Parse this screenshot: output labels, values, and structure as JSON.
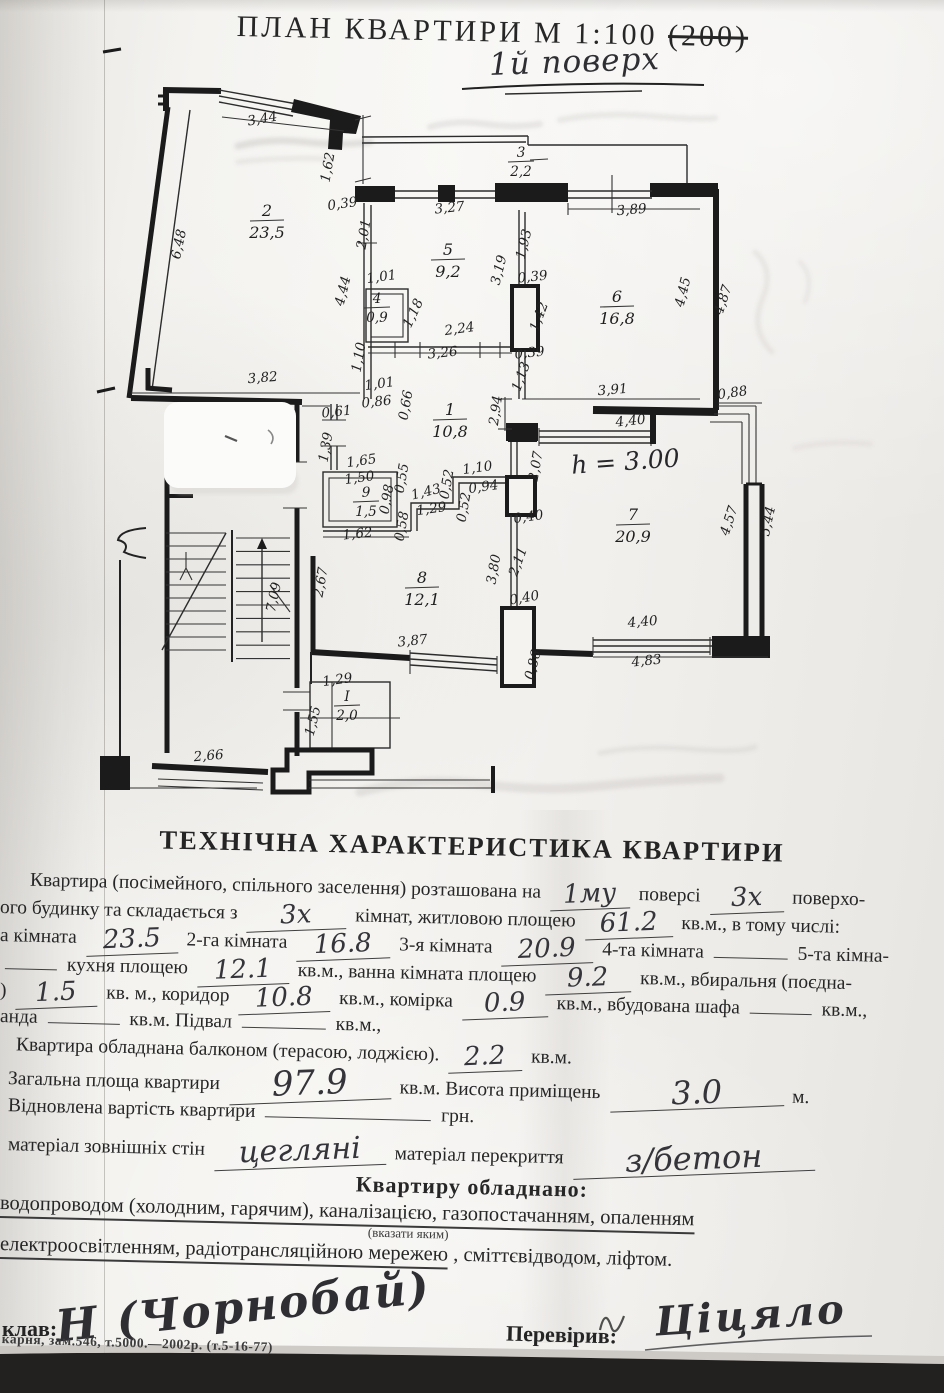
{
  "page": {
    "title": "ПЛАН  КВАРТИРИ  М 1:100",
    "title_struck": "(200)",
    "floor_note": "1й поверх"
  },
  "plan": {
    "height_note": "h = 3.00",
    "rooms": [
      {
        "n": "2",
        "a": "23,5",
        "x": 267,
        "y": 216
      },
      {
        "n": "5",
        "a": "9,2",
        "x": 448,
        "y": 255
      },
      {
        "n": "3",
        "a": "2,2",
        "x": 521,
        "y": 157,
        "small": true
      },
      {
        "n": "4",
        "a": "0,9",
        "x": 377,
        "y": 303,
        "small": true
      },
      {
        "n": "6",
        "a": "16,8",
        "x": 617,
        "y": 302
      },
      {
        "n": "1",
        "a": "10,8",
        "x": 450,
        "y": 415
      },
      {
        "n": "9",
        "a": "1,5",
        "x": 366,
        "y": 497,
        "small": true
      },
      {
        "n": "7",
        "a": "20,9",
        "x": 633,
        "y": 520
      },
      {
        "n": "8",
        "a": "12,1",
        "x": 422,
        "y": 583
      },
      {
        "n": "I",
        "a": "2,0",
        "x": 347,
        "y": 701,
        "small": true
      }
    ],
    "dims": [
      [
        "3,44",
        263,
        123,
        -10
      ],
      [
        "6,48",
        183,
        245,
        -78
      ],
      [
        "1,62",
        332,
        168,
        -80
      ],
      [
        "0,39",
        343,
        208,
        -8
      ],
      [
        "3,27",
        450,
        212,
        -6
      ],
      [
        "2,01",
        368,
        235,
        -80
      ],
      [
        "4,44",
        347,
        292,
        -76
      ],
      [
        "1,01",
        382,
        281,
        -8
      ],
      [
        "1,18",
        417,
        315,
        -65
      ],
      [
        "2,24",
        460,
        333,
        -8
      ],
      [
        "3,26",
        443,
        357,
        -6
      ],
      [
        "1,10",
        363,
        358,
        -80
      ],
      [
        "3,82",
        263,
        382,
        -5
      ],
      [
        "1,01",
        380,
        388,
        -8
      ],
      [
        "0,86",
        377,
        406,
        -6
      ],
      [
        "0,66",
        410,
        406,
        -80
      ],
      [
        "0,61",
        337,
        416,
        -6
      ],
      [
        "1,39",
        330,
        448,
        -80
      ],
      [
        "1,93",
        528,
        245,
        -76
      ],
      [
        "3,19",
        503,
        271,
        -76
      ],
      [
        "0,39",
        533,
        281,
        -6
      ],
      [
        "1,42",
        543,
        318,
        -70
      ],
      [
        "0,39",
        530,
        357,
        -6
      ],
      [
        "3,89",
        632,
        214,
        -5
      ],
      [
        "4,45",
        687,
        293,
        -76
      ],
      [
        "4,87",
        727,
        301,
        -72
      ],
      [
        "2,94",
        500,
        411,
        -82
      ],
      [
        "1,13",
        525,
        378,
        -70
      ],
      [
        "3,91",
        613,
        394,
        -5
      ],
      [
        "4,40",
        631,
        425,
        -6
      ],
      [
        "0,88",
        733,
        397,
        -8
      ],
      [
        "2,07",
        540,
        467,
        -80
      ],
      [
        "1,65",
        362,
        465,
        -8
      ],
      [
        "1,50",
        360,
        482,
        -8
      ],
      [
        "0,98",
        391,
        500,
        -80
      ],
      [
        "0,55",
        406,
        479,
        -80
      ],
      [
        "1,43",
        427,
        496,
        -14
      ],
      [
        "1,29",
        432,
        513,
        -8
      ],
      [
        "0,52",
        451,
        485,
        -80
      ],
      [
        "0,52",
        468,
        508,
        -80
      ],
      [
        "1,10",
        478,
        472,
        -8
      ],
      [
        "0,94",
        484,
        491,
        -8
      ],
      [
        "0,58",
        406,
        527,
        -80
      ],
      [
        "1,62",
        358,
        538,
        -6
      ],
      [
        "0,40",
        529,
        521,
        -8
      ],
      [
        "3,80",
        498,
        570,
        -80
      ],
      [
        "2,11",
        522,
        563,
        -70
      ],
      [
        "0,40",
        525,
        602,
        -10
      ],
      [
        "2,67",
        325,
        583,
        -80
      ],
      [
        "7,09",
        278,
        598,
        -78
      ],
      [
        "3,87",
        413,
        645,
        -6
      ],
      [
        "0,86",
        537,
        666,
        -75
      ],
      [
        "4,40",
        643,
        626,
        -5
      ],
      [
        "4,83",
        647,
        665,
        -6
      ],
      [
        "4,57",
        733,
        522,
        -72
      ],
      [
        "5,44",
        772,
        522,
        -78
      ],
      [
        "2,66",
        209,
        760,
        -5
      ],
      [
        "1,29",
        338,
        684,
        -8
      ],
      [
        "1,55",
        317,
        722,
        -76
      ]
    ]
  },
  "tech": {
    "heading": "ТЕХНІЧНА ХАРАКТЕРИСТИКА КВАРТИРИ",
    "lines": [
      {
        "top": 868,
        "indent": 30,
        "segs": [
          {
            "t": "Квартира (посімейного, спільного заселення) розташована на"
          },
          {
            "w": "1му",
            "wd": 64
          },
          {
            "t": "поверсі"
          },
          {
            "w": "3х",
            "wd": 58
          },
          {
            "t": "поверхо-"
          }
        ]
      },
      {
        "top": 896,
        "indent": 0,
        "segs": [
          {
            "t": "ого будинку та складається з"
          },
          {
            "w": "3х",
            "wd": 84
          },
          {
            "t": "кімнат, житловою площею"
          },
          {
            "w": "61.2",
            "wd": 72
          },
          {
            "t": "кв.м., в тому числі:"
          }
        ]
      },
      {
        "top": 924,
        "indent": 0,
        "segs": [
          {
            "t": "а кімната"
          },
          {
            "w": "23.5",
            "wd": 76
          },
          {
            "t": "2-га кімната"
          },
          {
            "w": "16.8",
            "wd": 78
          },
          {
            "t": "3-я кімната"
          },
          {
            "w": "20.9",
            "wd": 76
          },
          {
            "t": "4-та кімната"
          },
          {
            "u": 74
          },
          {
            "t": "5-та кімна-"
          }
        ]
      },
      {
        "top": 952,
        "indent": 0,
        "segs": [
          {
            "u": 52
          },
          {
            "t": "кухня площею"
          },
          {
            "w": "12.1",
            "wd": 76
          },
          {
            "t": "кв.м., ванна кімната площею"
          },
          {
            "w": "9.2",
            "wd": 70
          },
          {
            "t": "кв.м., вбиральня (поєдна-"
          }
        ]
      },
      {
        "top": 979,
        "indent": 0,
        "segs": [
          {
            "t": ")"
          },
          {
            "w": "1.5",
            "wd": 66
          },
          {
            "t": "кв. м., коридор"
          },
          {
            "w": "10.8",
            "wd": 76
          },
          {
            "t": "кв.м., комірка"
          },
          {
            "w": "0.9",
            "wd": 70
          },
          {
            "t": "кв.м., вбудована шафа"
          },
          {
            "u": 62
          },
          {
            "t": "кв.м.,"
          }
        ]
      },
      {
        "top": 1006,
        "indent": 0,
        "segs": [
          {
            "t": "анда"
          },
          {
            "u": 72
          },
          {
            "t": "кв.м. Підвал"
          },
          {
            "u": 84
          },
          {
            "t": "кв.м.,"
          }
        ]
      },
      {
        "top": 1033,
        "indent": 16,
        "segs": [
          {
            "t": "Квартира обладнана балконом (терасою, лоджією)."
          },
          {
            "w": "2.2",
            "wd": 58
          },
          {
            "t": "кв.м."
          }
        ]
      },
      {
        "top": 1061,
        "indent": 8,
        "segs": [
          {
            "t": "Загальна площа квартири"
          },
          {
            "w": "97.9",
            "wd": 146,
            "s": 34
          },
          {
            "t": "кв.м. Висота приміщень"
          },
          {
            "w": "3.0",
            "wd": 158,
            "s": 32
          },
          {
            "t": "м."
          }
        ]
      },
      {
        "top": 1095,
        "indent": 8,
        "segs": [
          {
            "t": "Відновлена вартість квартири"
          },
          {
            "u": 166
          },
          {
            "t": "грн."
          }
        ]
      },
      {
        "top": 1127,
        "indent": 8,
        "segs": [
          {
            "t": "матеріал зовнішніх стін"
          },
          {
            "w": "цегляні",
            "wd": 156,
            "s": 30
          },
          {
            "t": "матеріал перекриття"
          },
          {
            "w": "з/бетон",
            "wd": 226,
            "s": 32
          }
        ]
      },
      {
        "top": 1163,
        "center": true,
        "segs": [
          {
            "t": "Квартиру обладнано:"
          }
        ]
      },
      {
        "top": 1192,
        "indent": 0,
        "big": true,
        "segs": [
          {
            "t": "водопроводом (холодним, гарячим), каналізацією, газопостачанням, опаленням",
            "ul": 1
          }
        ]
      },
      {
        "top": 1216,
        "indent": 368,
        "small": true,
        "segs": [
          {
            "t": "(вказати яким)"
          }
        ]
      },
      {
        "top": 1233,
        "indent": 0,
        "big": true,
        "segs": [
          {
            "t": "електроосвітленням, радіотрансляційною мережею",
            "ul": 1
          },
          {
            "t": ", сміттєвідводом, ліфтом."
          }
        ]
      }
    ]
  },
  "footer": {
    "made_label": "клав:",
    "sig1": "Н (Чорнобай)",
    "checked_label": "Перевірив:",
    "sig2": "Ціцяло",
    "print_note": "карня, зам.546, т.5000.—2002р.  (т.5-16-77)"
  }
}
